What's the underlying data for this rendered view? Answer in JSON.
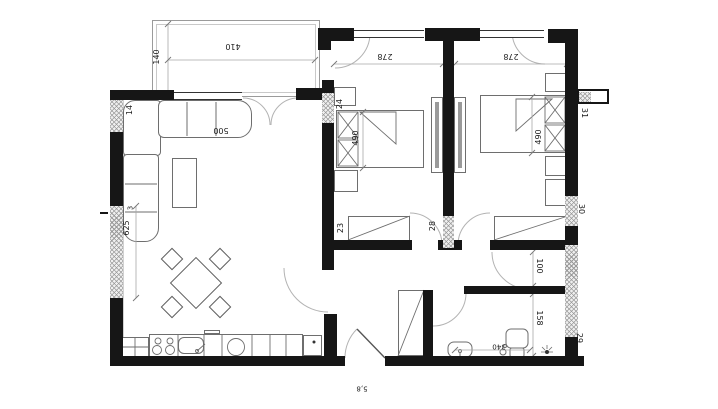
{
  "plan": {
    "dims": {
      "terrace_width": "410",
      "terrace_depth": "140",
      "living_sofa": "500",
      "bedroom1_width": "278",
      "bedroom2_width": "278",
      "bed1_length": "490",
      "bed2_length": "490",
      "left_wall_length": "625",
      "left_wall_seg": "3",
      "corridor_width": "100",
      "bath_length": "158",
      "bath_width": "340",
      "entry_mark": "5,8"
    },
    "wall_marks": {
      "top_left": "14",
      "bedroom1_west": "24",
      "bedroom1_south": "23",
      "partition": "28",
      "right_top": "31",
      "right_middle": "30",
      "right_bottom": "29"
    }
  }
}
